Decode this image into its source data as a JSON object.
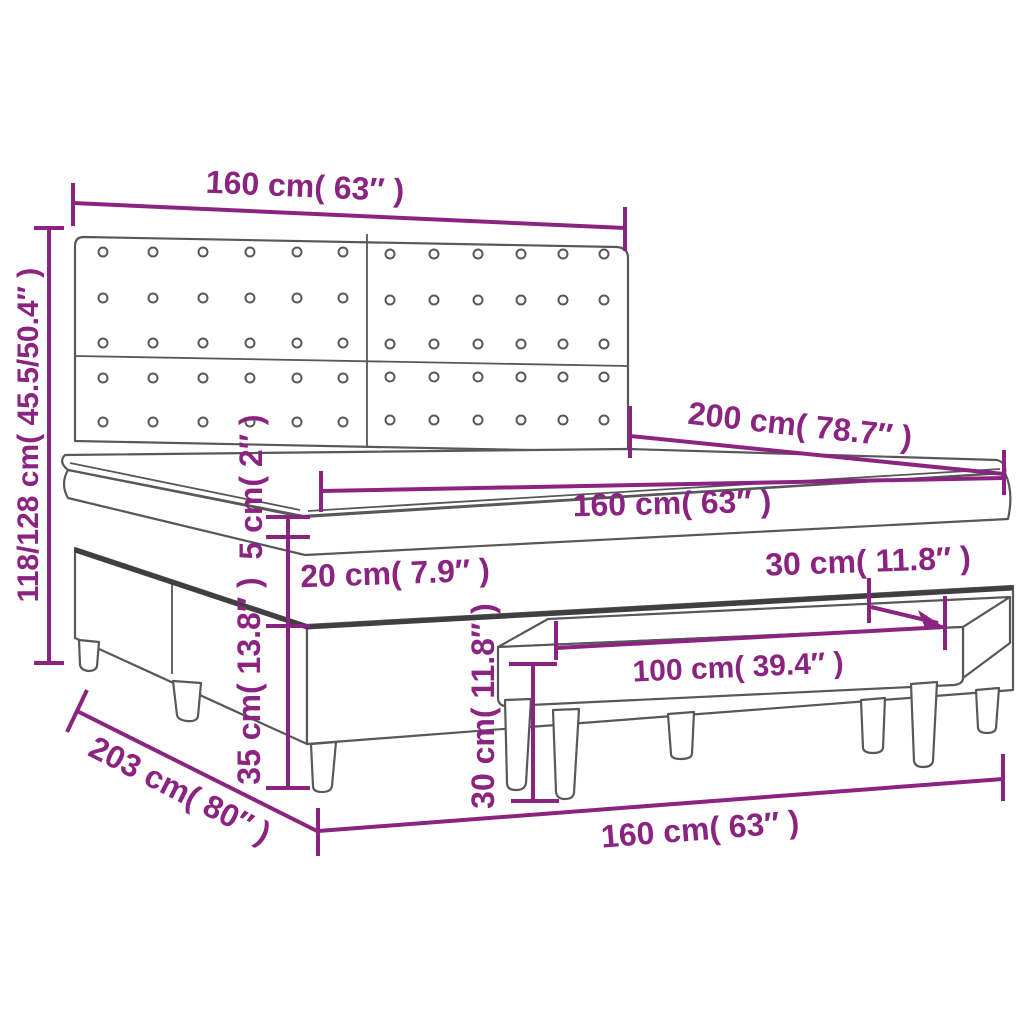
{
  "diagram": {
    "subject": "box spring bed with headboard, topper and bench - dimension diagram",
    "accent_color": "#8A2480",
    "outline_color": "#57585a"
  },
  "dimensions": {
    "headboard_width_top": {
      "label": "160 cm( 63″ )"
    },
    "bed_height_left": {
      "label": "118/128 cm( 45.5/50.4″ )"
    },
    "bed_length": {
      "label": "200 cm( 78.7″ )"
    },
    "mattress_width": {
      "label": "160 cm( 63″ )"
    },
    "topper_height": {
      "label": "5 cm( 2″ )"
    },
    "mattress_height": {
      "label": "20 cm( 7.9″ )"
    },
    "box_spring_height": {
      "label": "35 cm( 13.8″ )"
    },
    "bench_depth": {
      "label": "30 cm( 11.8″ )"
    },
    "bench_width": {
      "label": "100 cm( 39.4″ )"
    },
    "bench_height": {
      "label": "30 cm( 11.8″ )"
    },
    "frame_length_bottom": {
      "label": "203 cm( 80″ )"
    },
    "bed_width_bottom": {
      "label": "160 cm( 63″ )"
    }
  },
  "headboard": {
    "button_cols_left": [
      103,
      153,
      203,
      250,
      297,
      343
    ],
    "button_cols_right": [
      390,
      434,
      478,
      521,
      563,
      604
    ],
    "button_rows_left": [
      252,
      298,
      343,
      378,
      422
    ],
    "button_rows_right": [
      254,
      300,
      344,
      377,
      420
    ],
    "button_radius": 4.5
  }
}
